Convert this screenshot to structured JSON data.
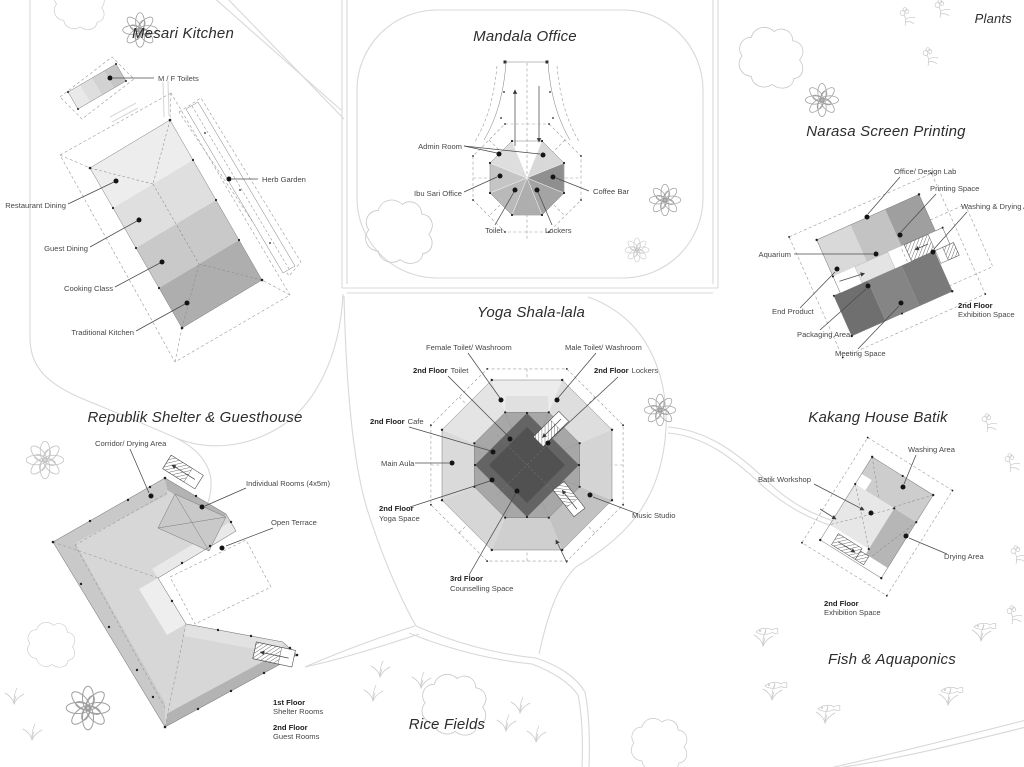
{
  "titles": {
    "mesari": "Mesari Kitchen",
    "mandala": "Mandala Office",
    "plants": "Plants",
    "narasa": "Narasa Screen Printing",
    "yoga": "Yoga Shala-lala",
    "republik": "Republik Shelter & Guesthouse",
    "kakang": "Kakang House Batik",
    "rice": "Rice Fields",
    "fish": "Fish & Aquaponics"
  },
  "mesari": {
    "toilets": "M / F Toilets",
    "herb": "Herb Garden",
    "restaurant": "Restaurant Dining",
    "guest": "Guest Dining",
    "cooking": "Cooking Class",
    "traditional": "Traditional Kitchen"
  },
  "mandala": {
    "admin": "Admin Room",
    "ibu": "Ibu Sari Office",
    "coffee": "Coffee Bar",
    "toilet": "Toilet",
    "lockers": "Lockers"
  },
  "narasa": {
    "office": "Office/ Design Lab",
    "printing": "Printing Space",
    "washing": "Washing & Drying Area",
    "aquarium": "Aquarium",
    "end_product": "End Product",
    "packaging": "Packaging Area",
    "meeting": "Meeting Space",
    "floor2": "2nd Floor",
    "floor2_use": "Exhibition Space"
  },
  "yoga": {
    "female": "Female Toilet/ Washroom",
    "male": "Male Toilet/ Washroom",
    "floor2": "2nd Floor",
    "floor3": "3rd Floor",
    "toilet": "Toilet",
    "lockers": "Lockers",
    "cafe": "Cafe",
    "aula": "Main Aula",
    "yoga_space": "Yoga Space",
    "music": "Music Studio",
    "counselling": "Counselling Space"
  },
  "republik": {
    "corridor": "Corridor/ Drying Area",
    "rooms": "Individual Rooms (4x5m)",
    "terrace": "Open Terrace",
    "floor1": "1st Floor",
    "floor1_use": "Shelter Rooms",
    "floor2": "2nd Floor",
    "floor2_use": "Guest Rooms"
  },
  "kakang": {
    "washing": "Washing Area",
    "workshop": "Batik Workshop",
    "drying": "Drying Area",
    "floor2": "2nd Floor",
    "floor2_use": "Exhibition Space"
  },
  "colors": {
    "building_light": "#ededed",
    "building_dark": "#6f6f6f",
    "center_dark": "#515151",
    "leader": "#4a4a4a",
    "path": "#d8d8d8"
  }
}
